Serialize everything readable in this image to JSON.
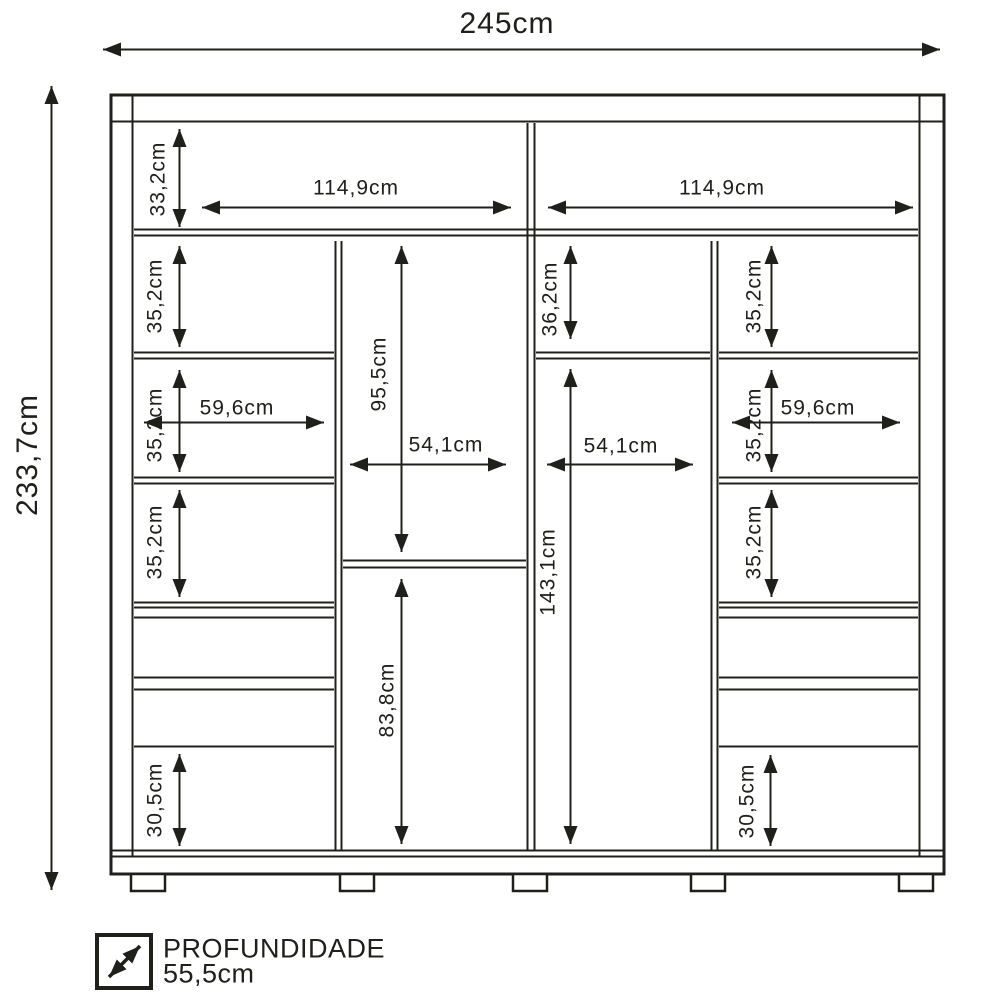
{
  "figure": {
    "type": "furniture-dimension-diagram",
    "overall": {
      "width": "245cm",
      "height": "233,7cm"
    },
    "top_row": {
      "height": "33,2cm",
      "left_width": "114,9cm",
      "right_width": "114,9cm"
    },
    "left_column": {
      "shelf1_height": "35,2cm",
      "shelf2_height": "35,2cm",
      "shelf2_width": "59,6cm",
      "shelf3_height": "35,2cm",
      "bottom_height": "30,5cm"
    },
    "center_left_column": {
      "upper_height": "95,5cm",
      "width": "54,1cm",
      "lower_height": "83,8cm"
    },
    "center_right_column": {
      "upper_height": "36,2cm",
      "main_height": "143,1cm",
      "width": "54,1cm"
    },
    "right_column": {
      "shelf1_height": "35,2cm",
      "shelf2_height": "35,2cm",
      "shelf2_width": "59,6cm",
      "shelf3_height": "35,2cm",
      "bottom_height": "30,5cm"
    },
    "legend": {
      "title": "PROFUNDIDADE",
      "value": "55,5cm"
    },
    "colors": {
      "line": "#20201a",
      "background": "#ffffff"
    }
  }
}
